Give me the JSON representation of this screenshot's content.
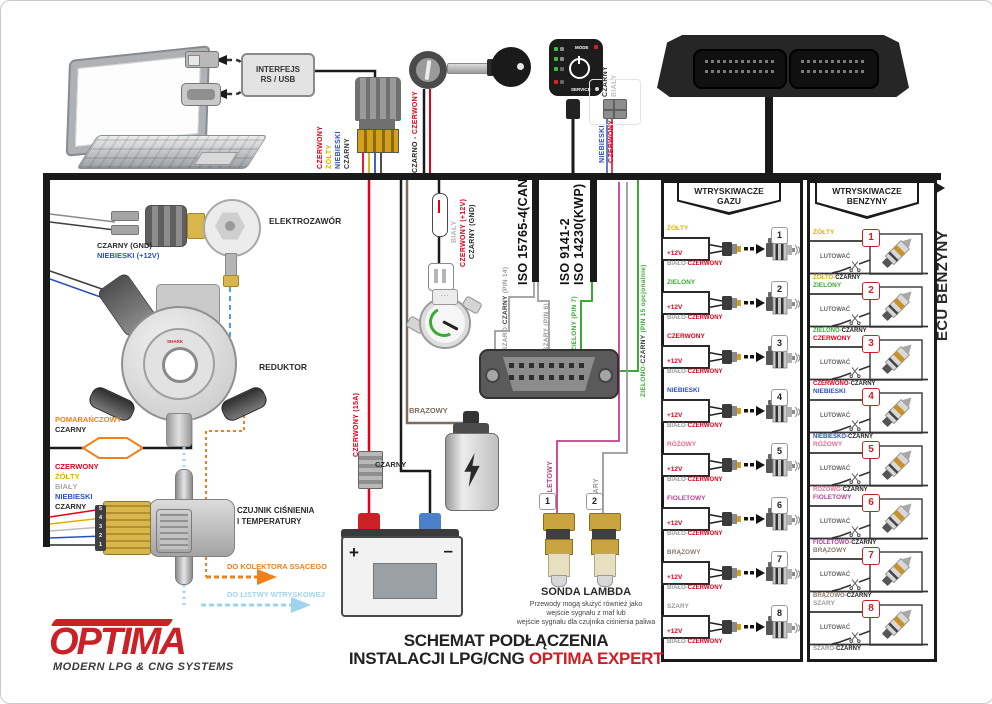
{
  "palette": {
    "red": "#e2001a",
    "yellow": "#e0b000",
    "blue": "#2a52be",
    "green": "#3aaa35",
    "pink": "#ef6a93",
    "violet": "#b5459b",
    "brown": "#7d6b5d",
    "gray": "#9a9a9a",
    "orange": "#f08019",
    "light_blue": "#9fd4ef",
    "black": "#1a1a1a",
    "logo_red": "#cc2027"
  },
  "interface": {
    "label_line1": "INTERFEJS",
    "label_line2": "RS / USB",
    "wires": [
      {
        "label": "CZERWONY",
        "hex": "#e2001a"
      },
      {
        "label": "ŻÓŁTY",
        "hex": "#e0b000"
      },
      {
        "label": "NIEBIESKI",
        "hex": "#2a52be"
      },
      {
        "label": "CZARNY",
        "hex": "#3a3a3a"
      }
    ]
  },
  "ignition": {
    "wire_part1": "CZARNO - ",
    "wire_part2": "CZERWONY"
  },
  "switch_panel": {
    "mode_label": "MODE",
    "service_label": "SERVICE",
    "wire_black": "CZARNY",
    "wire_white": "BIAŁY",
    "wire_blue": "NIEBIESKI",
    "wire_red": "CZERWONY"
  },
  "ecu": {
    "side_label": "ECU BENZYNY"
  },
  "elektrozawor": {
    "label": "ELEKTROZAWÓR",
    "wire_gnd": "CZARNY (GND)",
    "wire_12v": "NIEBIESKI (+12V)"
  },
  "reduktor": {
    "label": "REDUKTOR",
    "brand": "SHARK"
  },
  "map_loop": {
    "wire1": "POMARAŃCZOWY",
    "wire2": "CZARNY"
  },
  "pressure_sensor": {
    "label_line1": "CZUJNIK CIŚNIENIA",
    "label_line2": "I TEMPERATURY",
    "wires": [
      {
        "label": "CZERWONY",
        "hex": "#e2001a"
      },
      {
        "label": "ŻÓŁTY",
        "hex": "#e0b000"
      },
      {
        "label": "BIAŁY",
        "hex": "#aaaaaa"
      },
      {
        "label": "NIEBIESKI",
        "hex": "#2a52be"
      },
      {
        "label": "CZARNY",
        "hex": "#3a3a3a"
      }
    ],
    "pin_numbers": [
      "5",
      "4",
      "3",
      "2",
      "1"
    ]
  },
  "flows": {
    "orange_arrow": "DO KOLEKTORA SSĄCEGO",
    "blue_arrow": "DO LISTWY WTRYSKOWEJ"
  },
  "power": {
    "gauge_wire_white": "BIAŁY",
    "gauge_wire_red": "CZERWONY (+12V)",
    "gauge_wire_black": "CZARNY (GND)",
    "battery_red": "CZERWONY (15A)",
    "battery_black": "CZARNY",
    "plus": "+",
    "minus": "–"
  },
  "coil": {
    "wire": "BRĄZOWY"
  },
  "obd": {
    "iso_can": "ISO 15765-4(CAN)",
    "iso_9141": "ISO 9141-2",
    "iso_14230": "ISO 14230(KWP)",
    "pin14_part1": "SZARO-",
    "pin14_part2": "CZARNY",
    "pin14_part3": " (PIN 14)",
    "pin6": "SZARY (PIN 6)",
    "pin7": "ZIELONY (PIN 7)",
    "pin15_part1": "ZIELONO-",
    "pin15_part2": "CZARNY",
    "pin15_part3": " (PIN 15 opcjonalnie)"
  },
  "lambda": {
    "title": "SONDA LAMBDA",
    "desc_line1": "Przewody mogą służyć również jako",
    "desc_line2": "wejście sygnału z maf lub",
    "desc_line3": "wejście sygnału dla czujnika ciśnienia paliwa",
    "probe1": {
      "num": "1",
      "wire": "FIOLETOWY",
      "hex": "#c2408f"
    },
    "probe2": {
      "num": "2",
      "wire": "SZARY",
      "hex": "#9a9a9a"
    }
  },
  "gas_injectors": {
    "header_line1": "WTRYSKIWACZE",
    "header_line2": "GAZU",
    "supply": "+12V",
    "ground_part1": "BIAŁO-",
    "ground_part2": "CZERWONY",
    "rows": [
      {
        "num": "1",
        "color": "ŻÓŁTY",
        "hex": "#e0b000"
      },
      {
        "num": "2",
        "color": "ZIELONY",
        "hex": "#3aaa35"
      },
      {
        "num": "3",
        "color": "CZERWONY",
        "hex": "#e2001a"
      },
      {
        "num": "4",
        "color": "NIEBIESKI",
        "hex": "#2a52be"
      },
      {
        "num": "5",
        "color": "RÓŻOWY",
        "hex": "#ef6a93"
      },
      {
        "num": "6",
        "color": "FIOLETOWY",
        "hex": "#b5459b"
      },
      {
        "num": "7",
        "color": "BRĄZOWY",
        "hex": "#8d7b6e"
      },
      {
        "num": "8",
        "color": "SZARY",
        "hex": "#9a9a9a"
      }
    ]
  },
  "petrol_injectors": {
    "header_line1": "WTRYSKIWACZE",
    "header_line2": "BENZYNY",
    "solder_label": "LUTOWAĆ",
    "rows": [
      {
        "num": "1",
        "top": "ŻÓŁTY",
        "top_hex": "#e0b000",
        "bottom_part1": "ŻÓŁTO-",
        "bottom_part2": "CZARNY"
      },
      {
        "num": "2",
        "top": "ZIELONY",
        "top_hex": "#3aaa35",
        "bottom_part1": "ZIELONO-",
        "bottom_part2": "CZARNY"
      },
      {
        "num": "3",
        "top": "CZERWONY",
        "top_hex": "#e2001a",
        "bottom_part1": "CZERWONO-",
        "bottom_part2": "CZARNY"
      },
      {
        "num": "4",
        "top": "NIEBIESKI",
        "top_hex": "#2a52be",
        "bottom_part1": "NIEBIESKO-",
        "bottom_part2": "CZARNY"
      },
      {
        "num": "5",
        "top": "RÓŻOWY",
        "top_hex": "#ef6a93",
        "bottom_part1": "RÓŻOWO-",
        "bottom_part2": "CZARNY"
      },
      {
        "num": "6",
        "top": "FIOLETOWY",
        "top_hex": "#b5459b",
        "bottom_part1": "FIOLETOWO-",
        "bottom_part2": "CZARNY"
      },
      {
        "num": "7",
        "top": "BRĄZOWY",
        "top_hex": "#8d7b6e",
        "bottom_part1": "BRĄZOWO-",
        "bottom_part2": "CZARNY"
      },
      {
        "num": "8",
        "top": "SZARY",
        "top_hex": "#9a9a9a",
        "bottom_part1": "SZARO-",
        "bottom_part2": "CZARNY"
      }
    ]
  },
  "footer": {
    "logo_text": "OPTIMA",
    "logo_tagline": "MODERN LPG & CNG SYSTEMS",
    "title_line1": "SCHEMAT PODŁĄCZENIA",
    "title_line2_black": "INSTALACJI LPG/CNG ",
    "title_line2_red": "OPTIMA EXPERT"
  }
}
